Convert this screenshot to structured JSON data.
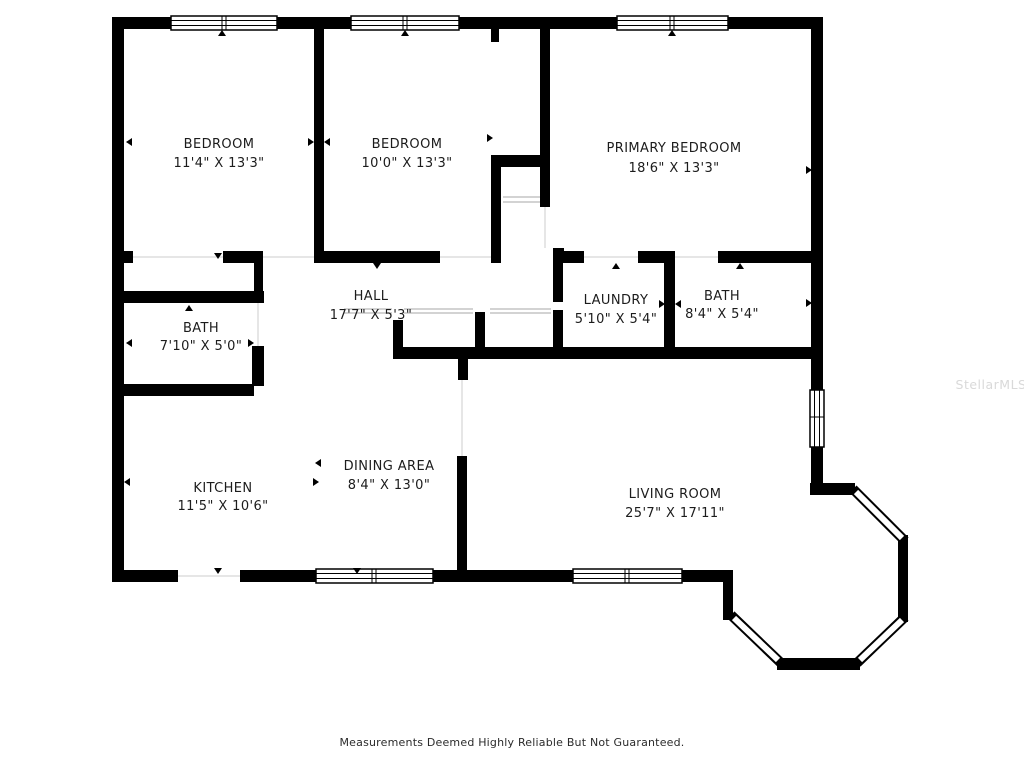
{
  "floorplan": {
    "watermark": "StellarMLS",
    "caption": "Measurements Deemed Highly Reliable But Not Guaranteed.",
    "colors": {
      "wall": "#000000",
      "background": "#ffffff",
      "label_text": "#1c1c1c",
      "watermark_text": "#d9d9d9",
      "shelf_line": "#b9b9b9"
    },
    "rooms": [
      {
        "name": "BEDROOM",
        "dims": "11'4\" X 13'3\""
      },
      {
        "name": "BEDROOM",
        "dims": "10'0\" X 13'3\""
      },
      {
        "name": "PRIMARY BEDROOM",
        "dims": "18'6\" X 13'3\""
      },
      {
        "name": "HALL",
        "dims": "17'7\" X 5'3\""
      },
      {
        "name": "BATH",
        "dims": "7'10\" X 5'0\""
      },
      {
        "name": "LAUNDRY",
        "dims": "5'10\" X 5'4\""
      },
      {
        "name": "BATH",
        "dims": "8'4\" X 5'4\""
      },
      {
        "name": "KITCHEN",
        "dims": "11'5\" X 10'6\""
      },
      {
        "name": "DINING AREA",
        "dims": "8'4\" X 13'0\""
      },
      {
        "name": "LIVING ROOM",
        "dims": "25'7\" X 17'11\""
      }
    ]
  }
}
